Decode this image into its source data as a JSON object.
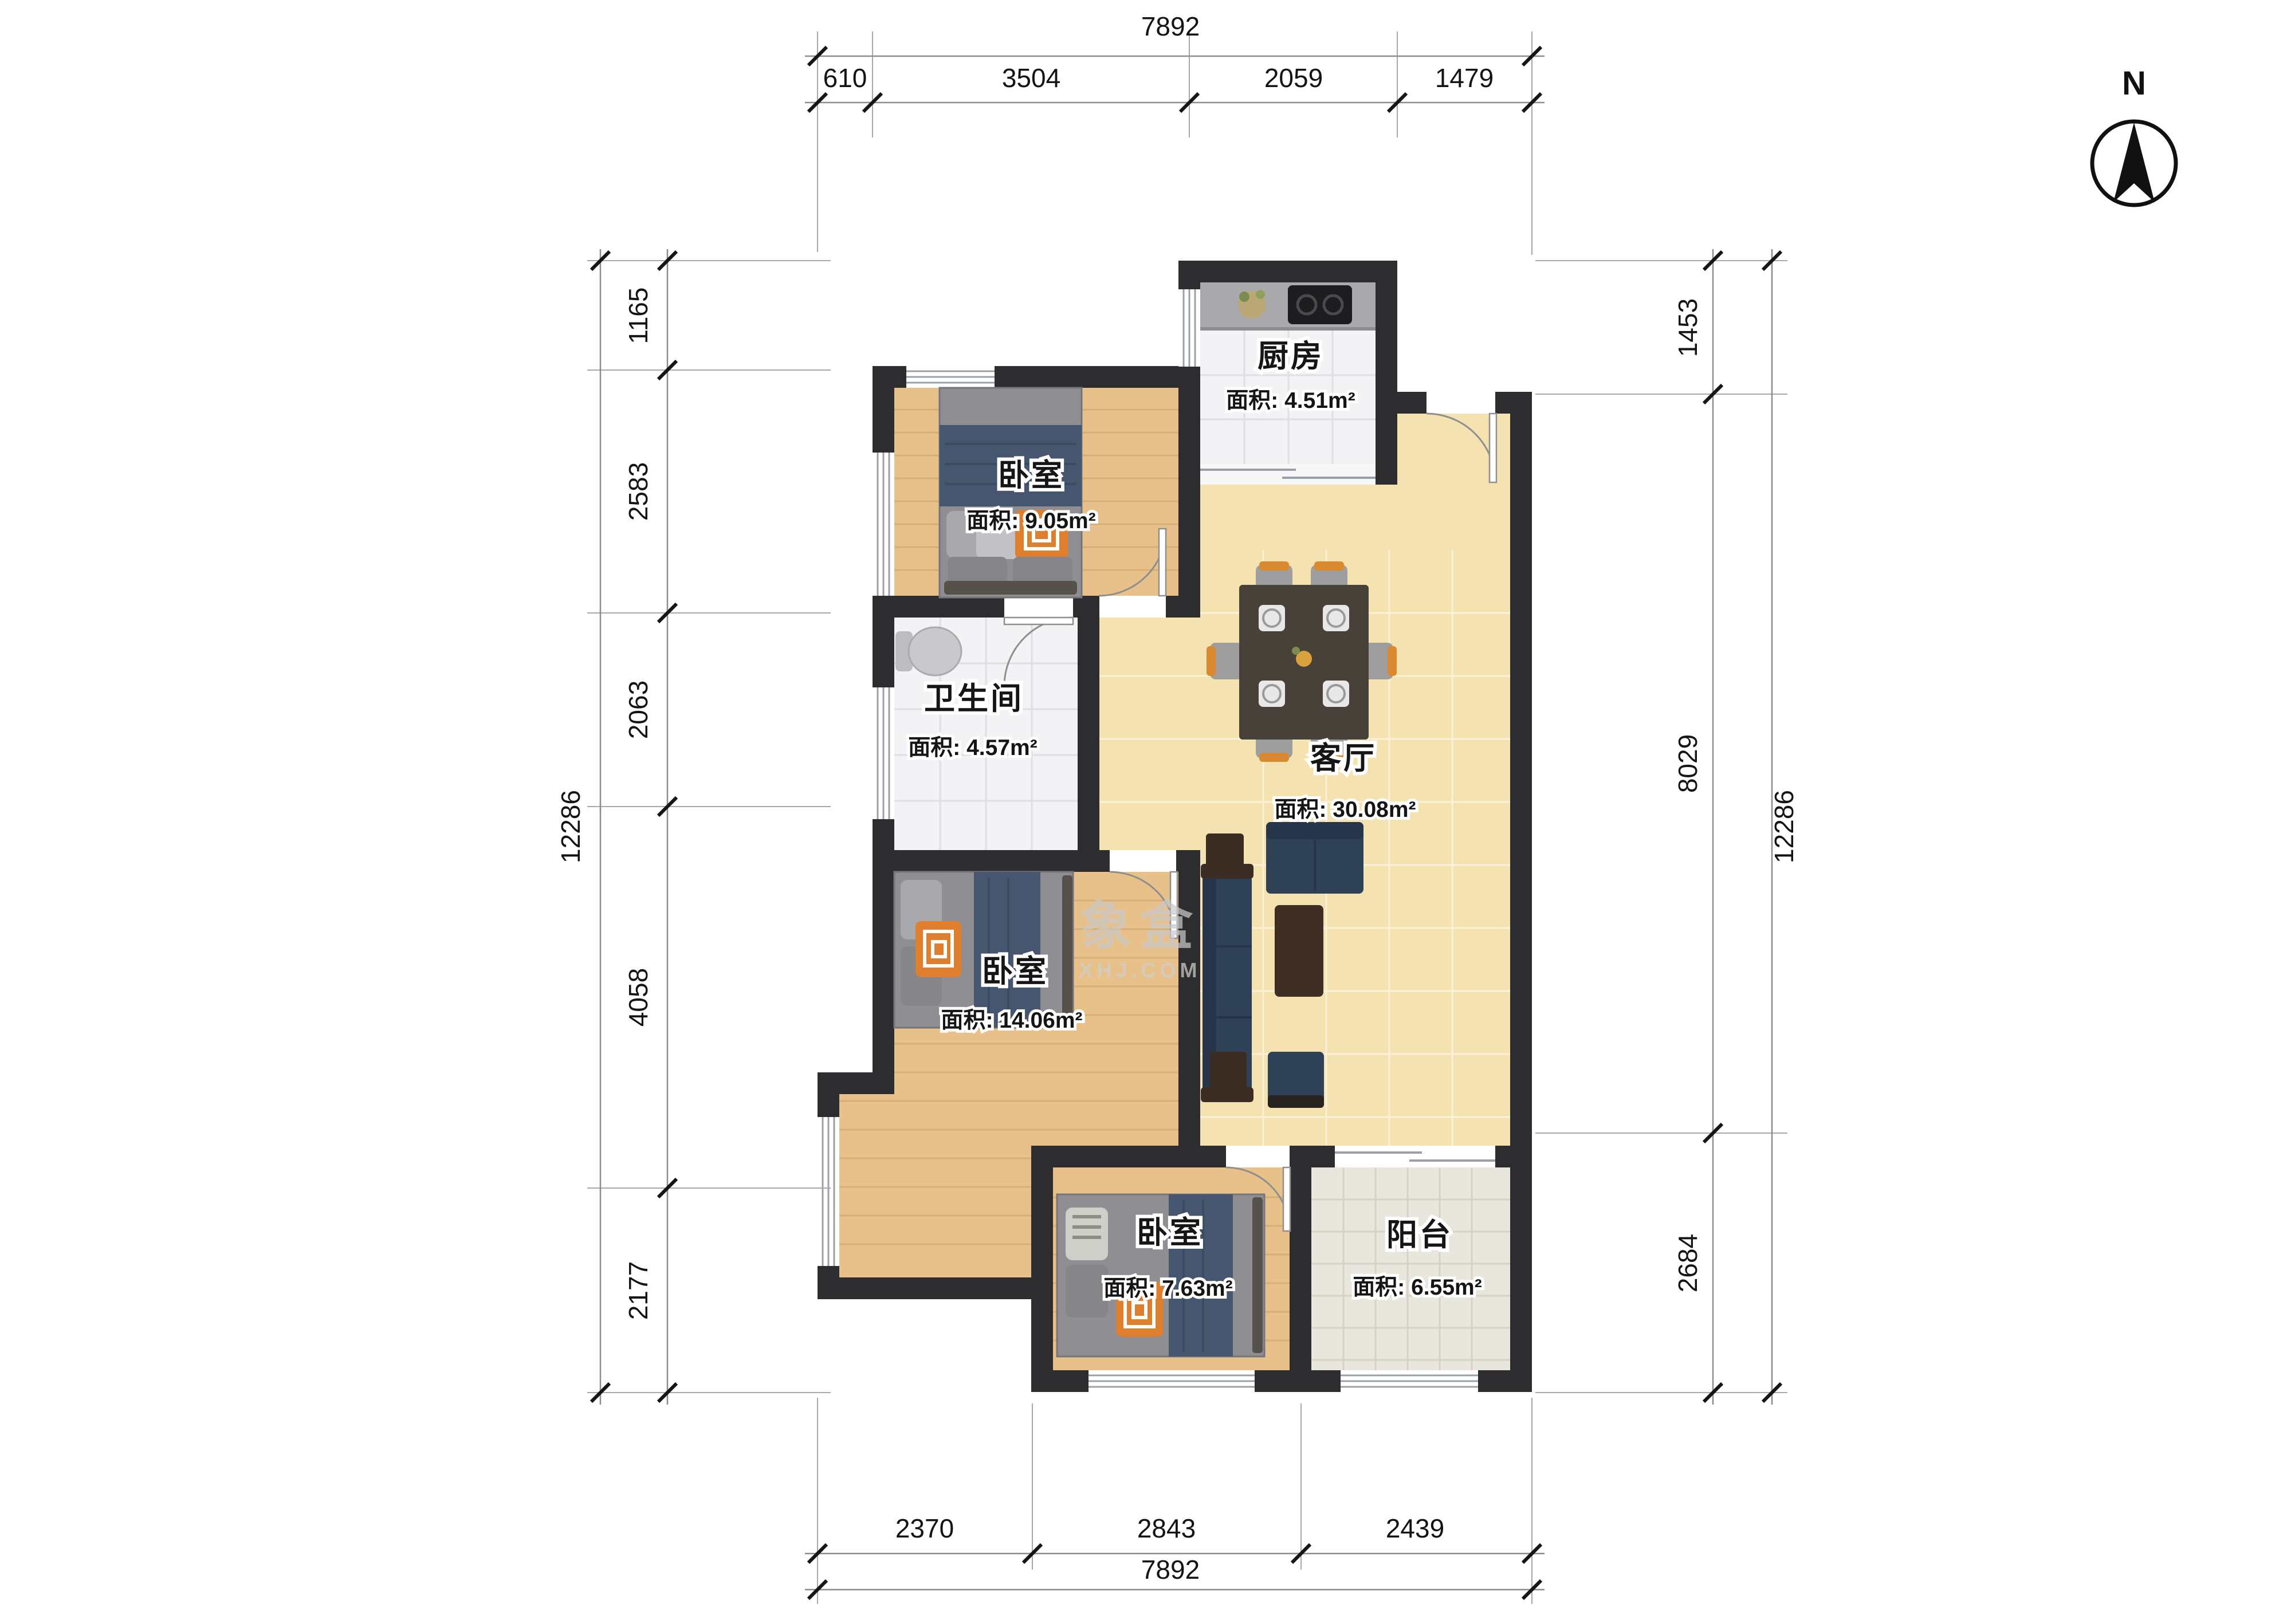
{
  "compass": {
    "label": "N"
  },
  "watermark": {
    "line1": "象盒",
    "line2": "XHJ.COM"
  },
  "rooms": [
    {
      "id": "kitchen",
      "name": "厨房",
      "area": "面积: 4.51m²"
    },
    {
      "id": "bedroom-top",
      "name": "卧室",
      "area": "面积: 9.05m²"
    },
    {
      "id": "bathroom",
      "name": "卫生间",
      "area": "面积: 4.57m²"
    },
    {
      "id": "living-room",
      "name": "客厅",
      "area": "面积: 30.08m²"
    },
    {
      "id": "bedroom-middle",
      "name": "卧室",
      "area": "面积: 14.06m²"
    },
    {
      "id": "bedroom-bottom",
      "name": "卧室",
      "area": "面积: 7.63m²"
    },
    {
      "id": "balcony",
      "name": "阳台",
      "area": "面积: 6.55m²"
    }
  ],
  "dimensions": {
    "top": {
      "total": "7892",
      "segments": [
        "610",
        "3504",
        "2059",
        "1479"
      ]
    },
    "bottom": {
      "total": "7892",
      "segments": [
        "2370",
        "2843",
        "2439"
      ]
    },
    "left": {
      "total": "12286",
      "segments": [
        "1165",
        "2583",
        "2063",
        "4058",
        "2177"
      ]
    },
    "right": {
      "total": "12286",
      "segments": [
        "1453",
        "8029",
        "2684"
      ]
    }
  },
  "colors": {
    "wall": "#2d2d30",
    "wood_floor": "#e7c189",
    "living_floor": "#f4e2b0",
    "tile_floor": "#f3f3f5",
    "balcony_floor": "#e9e6dd",
    "sofa_navy": "#2f4156",
    "accent_orange": "#df7f2e"
  }
}
